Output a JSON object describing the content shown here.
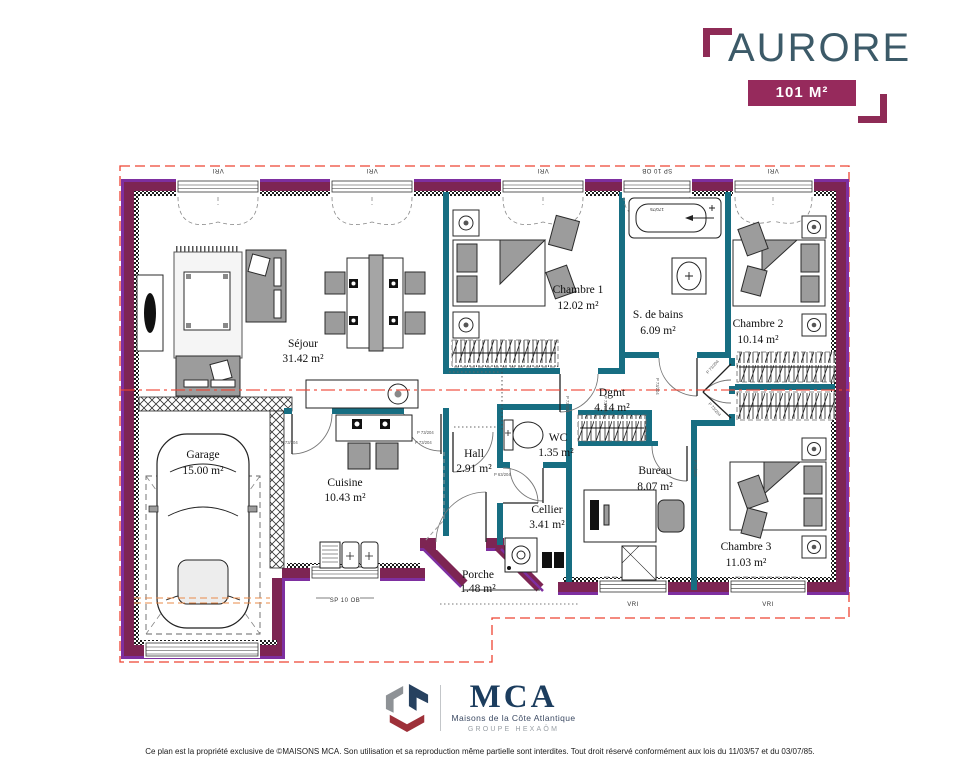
{
  "header": {
    "title": "AURORE",
    "area_label": "101 M²"
  },
  "rooms": {
    "sejour": {
      "name": "Séjour",
      "area": "31.42 m²"
    },
    "chambre1": {
      "name": "Chambre 1",
      "area": "12.02 m²"
    },
    "sdb": {
      "name": "S. de bains",
      "area": "6.09 m²"
    },
    "chambre2": {
      "name": "Chambre 2",
      "area": "10.14 m²"
    },
    "garage": {
      "name": "Garage",
      "area": "15.00 m²"
    },
    "cuisine": {
      "name": "Cuisine",
      "area": "10.43 m²"
    },
    "hall": {
      "name": "Hall",
      "area": "2.91 m²"
    },
    "wc": {
      "name": "WC",
      "area": "1.35 m²"
    },
    "dgmt": {
      "name": "Dgmt",
      "area": "4.14 m²"
    },
    "cellier": {
      "name": "Cellier",
      "area": "3.41 m²"
    },
    "bureau": {
      "name": "Bureau",
      "area": "8.07 m²"
    },
    "chambre3": {
      "name": "Chambre 3",
      "area": "11.03 m²"
    },
    "porche": {
      "name": "Porche",
      "area": "1.48 m²"
    }
  },
  "plan_labels": {
    "window_roller": "VRI",
    "window_bay": "SP 10 OB",
    "door_standard": "P 73/204",
    "door_wc": "P 63/204",
    "bathtub_size": "170/75"
  },
  "logo": {
    "acronym": "MCA",
    "subtitle": "Maisons de la Côte Atlantique",
    "group": "GROUPE HEXAÔM"
  },
  "footer": {
    "disclaimer": "Ce plan est la propriété exclusive de ©MAISONS MCA. Son utilisation et sa reproduction même partielle sont interdites. Tout droit réservé conformément aux lois du 11/03/57 et du 03/07/85."
  },
  "colors": {
    "exterior_wall": "#7d2553",
    "wall_edge": "#7e2fa0",
    "partition_wall": "#176e82",
    "roofline": "#ee4433",
    "accent": "#962a5c",
    "title": "#3c5a68"
  }
}
